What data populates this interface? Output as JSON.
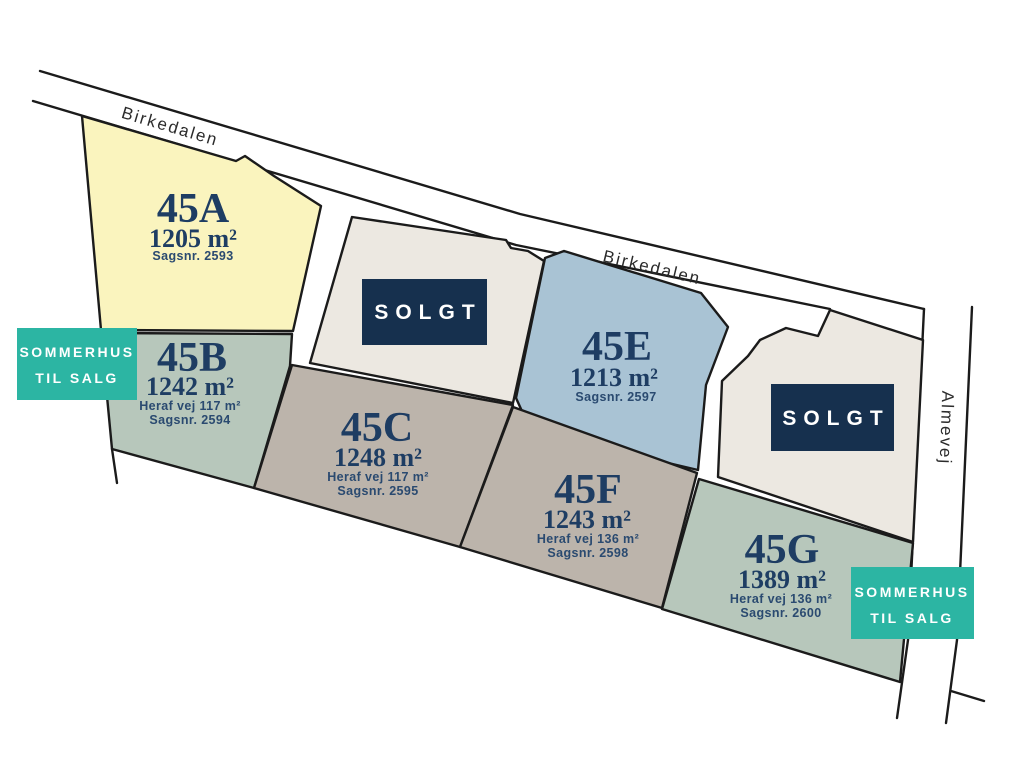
{
  "map": {
    "background": "#ffffff",
    "outline_color": "#1b1b1b",
    "label_color": "#1e3d63"
  },
  "roads": {
    "birkedalen_upper": {
      "name": "Birkedalen"
    },
    "birkedalen_lower": {
      "name": "Birkedalen"
    },
    "almevej": {
      "name": "Almevej"
    }
  },
  "plots": [
    {
      "id": "45A",
      "label": "45A",
      "area": "1205 m²",
      "case": "Sagsnr. 2593",
      "color": "#faf4be",
      "status": "til salg"
    },
    {
      "id": "45B",
      "label": "45B",
      "area": "1242 m²",
      "road_share": "Heraf vej 117 m²",
      "case": "Sagsnr. 2594",
      "color": "#b7c7bb",
      "status": "sommerhus til salg"
    },
    {
      "id": "45C",
      "label": "45C",
      "area": "1248 m²",
      "road_share": "Heraf vej 117 m²",
      "case": "Sagsnr. 2595",
      "color": "#bcb4ab",
      "status": "til salg"
    },
    {
      "id": "sold-1",
      "label": "SOLGT",
      "color": "#ece8e1",
      "status": "solgt"
    },
    {
      "id": "45E",
      "label": "45E",
      "area": "1213 m²",
      "case": "Sagsnr. 2597",
      "color": "#a9c3d4",
      "status": "til salg"
    },
    {
      "id": "45F",
      "label": "45F",
      "area": "1243 m²",
      "road_share": "Heraf vej 136 m²",
      "case": "Sagsnr. 2598",
      "color": "#bcb4ab",
      "status": "til salg"
    },
    {
      "id": "45G",
      "label": "45G",
      "area": "1389 m²",
      "road_share": "Heraf vej 136 m²",
      "case": "Sagsnr. 2600",
      "color": "#b7c7bb",
      "status": "sommerhus til salg"
    },
    {
      "id": "sold-2",
      "label": "SOLGT",
      "color": "#ece8e1",
      "status": "solgt"
    }
  ],
  "sold_badge": {
    "text": "SOLGT",
    "bg": "#16304e",
    "fg": "#ffffff"
  },
  "sale_badge": {
    "line1": "SOMMERHUS",
    "line2": "TIL SALG",
    "bg": "#2cb5a3",
    "fg": "#ffffff"
  }
}
